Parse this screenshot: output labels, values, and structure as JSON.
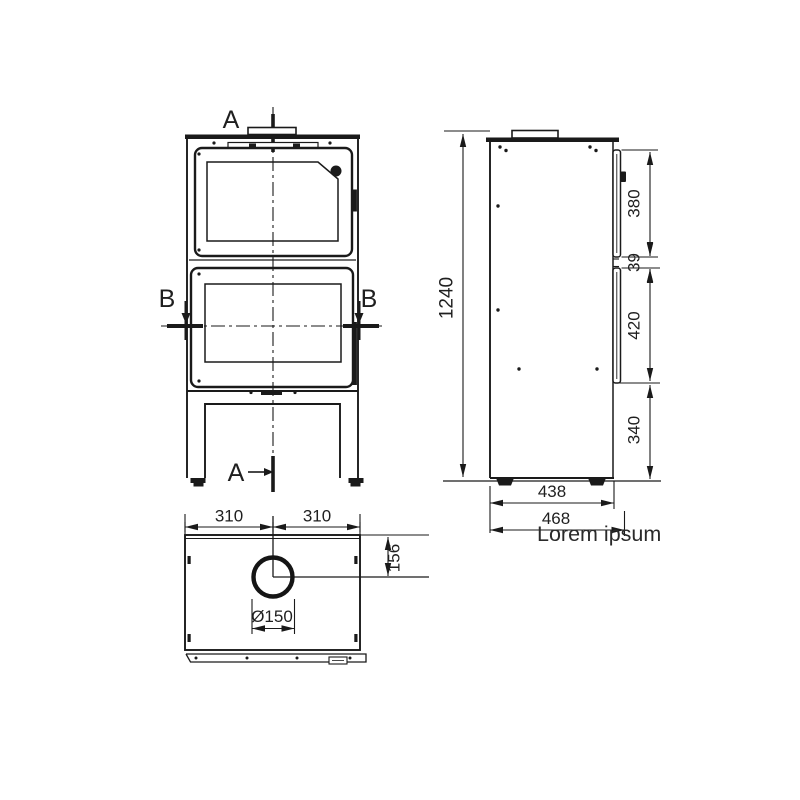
{
  "page": {
    "background": "#ffffff",
    "line_color": "#1a1a1a"
  },
  "front_view": {
    "section_label_top": "A",
    "section_label_bottom": "A",
    "section_label_left": "B",
    "section_label_right": "B"
  },
  "side_view": {
    "overall_height": "1240",
    "upper_door_height": "380",
    "door_gap": "39",
    "lower_door_height": "420",
    "base_height": "340",
    "body_depth": "438",
    "overall_depth": "468",
    "caption": "Lorem ipsum"
  },
  "top_view": {
    "flue_offset_left": "310",
    "flue_offset_right": "310",
    "flue_offset_rear": "156",
    "flue_diameter": "Ø150"
  }
}
